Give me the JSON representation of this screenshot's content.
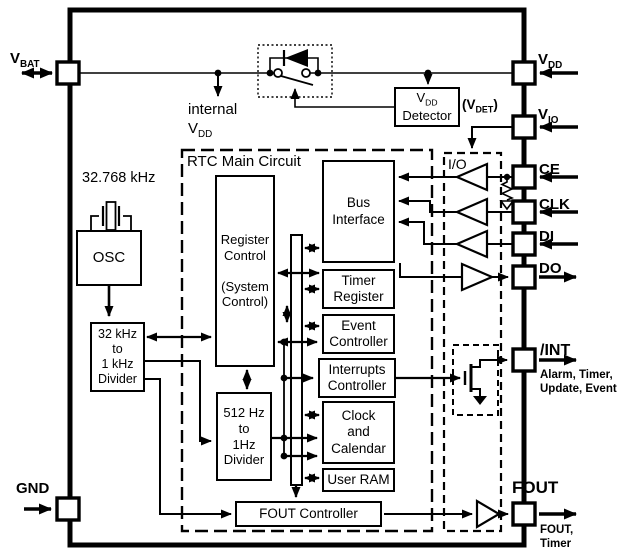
{
  "pins": {
    "vbat": {
      "base": "V",
      "sub": "BAT"
    },
    "vdd": {
      "base": "V",
      "sub": "DD"
    },
    "vio": {
      "base": "V",
      "sub": "IO"
    },
    "ce": "CE",
    "clk": "CLK",
    "di": "DI",
    "do": "DO",
    "int": "/INT",
    "fout": "FOUT",
    "gnd": "GND",
    "int_note": [
      "Alarm, Timer,",
      "Update, Event"
    ],
    "fout_note": [
      "FOUT,",
      "Timer"
    ]
  },
  "annotations": {
    "internal_vdd_line1": "internal",
    "internal_vdd_base": "V",
    "internal_vdd_sub": "DD",
    "crystal_freq": "32.768 kHz",
    "vdet_open": "(V",
    "vdet_sub": "DET",
    "vdet_close": ")",
    "rtc_main_circuit": "RTC Main Circuit",
    "io_block": "I/O"
  },
  "blocks": {
    "osc": "OSC",
    "divider_32k": [
      "32 kHz",
      "to",
      "1 kHz",
      "Divider"
    ],
    "divider_512": [
      "512 Hz",
      "to",
      "1Hz",
      "Divider"
    ],
    "vdd_detector": {
      "base": "V",
      "sub": "DD",
      "line2": "Detector"
    },
    "register_control": [
      "Register",
      "Control",
      "(System",
      "Control)"
    ],
    "bus_interface": [
      "Bus",
      "Interface"
    ],
    "timer_register": [
      "Timer",
      "Register"
    ],
    "event_controller": [
      "Event",
      "Controller"
    ],
    "interrupts_controller": [
      "Interrupts",
      "Controller"
    ],
    "clock_calendar": [
      "Clock",
      "and",
      "Calendar"
    ],
    "user_ram": "User RAM",
    "fout_controller": "FOUT Controller"
  },
  "colors": {
    "line": "#000000",
    "background": "#ffffff"
  }
}
